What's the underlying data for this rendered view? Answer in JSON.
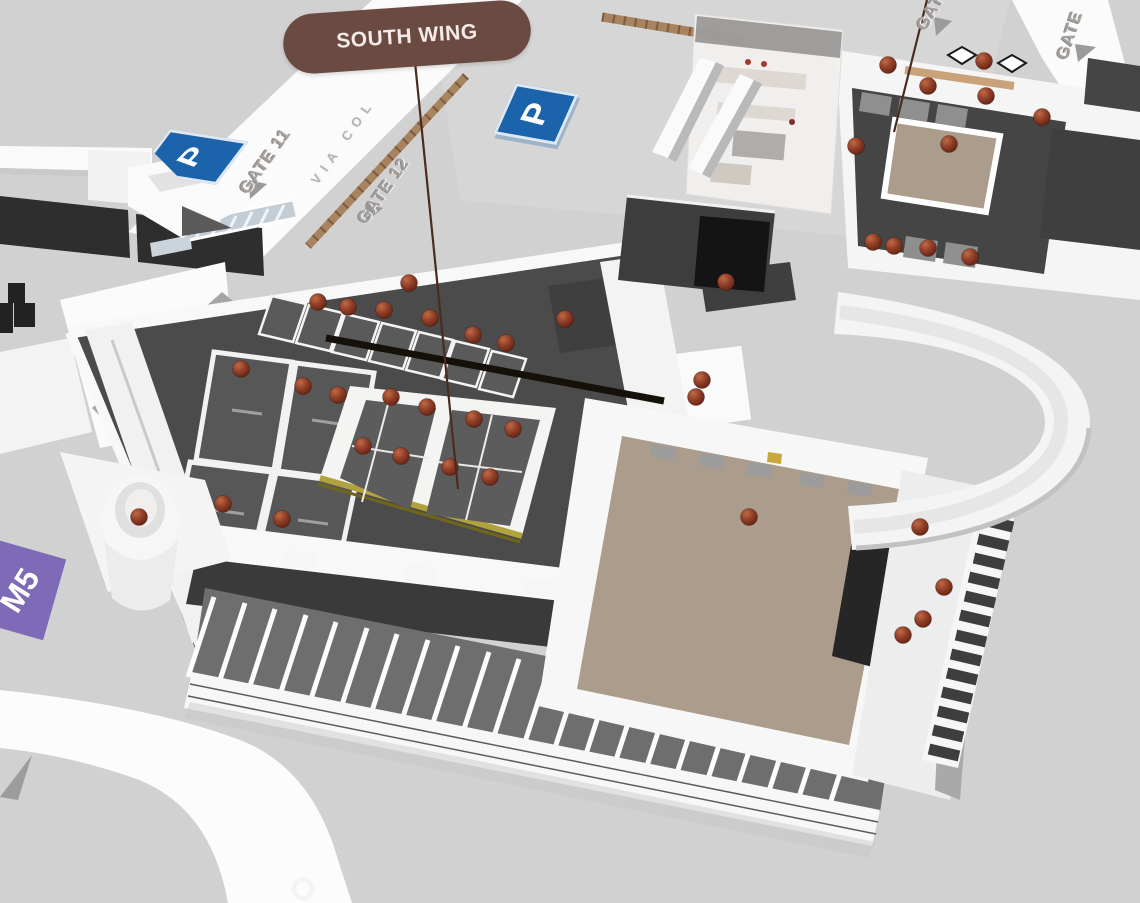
{
  "scene": {
    "title": "3D venue map – exhibition centre overview",
    "callout": {
      "label": "SOUTH WING",
      "bg_color": "#6b4a42",
      "text_color": "#f3ebe7"
    },
    "gates": [
      {
        "id": "gate-11",
        "label": "GATE 11"
      },
      {
        "id": "gate-12",
        "label": "GATE 12"
      },
      {
        "id": "gate-ne-left",
        "label": "GATE"
      },
      {
        "id": "gate-ne-right",
        "label": "GATE"
      }
    ],
    "street": {
      "label": "VIA COL"
    },
    "parking": {
      "label": "P",
      "color": "#1b63ab"
    },
    "metro": {
      "label": "M5",
      "color": "#7e6ab6"
    },
    "colors": {
      "ground": "#d2d1d2",
      "road": "#fbfbfb",
      "wall_white": "#f6f6f6",
      "floor_dark": "#4b4b4b",
      "floor_tan": "#ab9c8b",
      "highlight_yellow": "#b0a23c",
      "marker": "#8a3a20",
      "beam_black": "#151008",
      "brick_wall": "#a8835f"
    },
    "markers": [
      [
        318,
        302
      ],
      [
        348,
        307
      ],
      [
        384,
        310
      ],
      [
        409,
        283
      ],
      [
        430,
        318
      ],
      [
        473,
        335
      ],
      [
        506,
        343
      ],
      [
        241,
        369
      ],
      [
        303,
        386
      ],
      [
        338,
        395
      ],
      [
        391,
        397
      ],
      [
        427,
        407
      ],
      [
        474,
        419
      ],
      [
        513,
        429
      ],
      [
        363,
        446
      ],
      [
        401,
        456
      ],
      [
        450,
        467
      ],
      [
        490,
        477
      ],
      [
        223,
        504
      ],
      [
        282,
        519
      ],
      [
        139,
        517
      ],
      [
        565,
        319
      ],
      [
        726,
        282
      ],
      [
        702,
        380
      ],
      [
        696,
        397
      ],
      [
        749,
        517
      ],
      [
        856,
        146
      ],
      [
        888,
        65
      ],
      [
        928,
        86
      ],
      [
        949,
        144
      ],
      [
        984,
        61
      ],
      [
        986,
        96
      ],
      [
        1042,
        117
      ],
      [
        873,
        242
      ],
      [
        894,
        246
      ],
      [
        928,
        248
      ],
      [
        970,
        257
      ],
      [
        920,
        527
      ],
      [
        944,
        587
      ],
      [
        923,
        619
      ],
      [
        903,
        635
      ]
    ]
  }
}
